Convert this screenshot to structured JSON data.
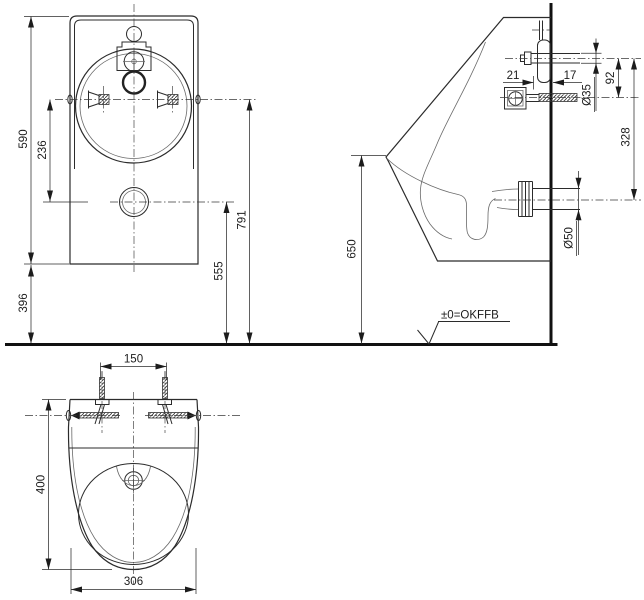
{
  "drawing": {
    "type": "technical-installation-drawing",
    "colors": {
      "line": "#2b2b2b",
      "background": "#ffffff"
    },
    "front_view": {
      "overall_height": "590",
      "fixing_to_drain": "236",
      "bottom_to_floor": "396",
      "fixing_height": "791",
      "drain_height": "555"
    },
    "side_view": {
      "fixing_offset_front": "21",
      "fixing_offset_back": "17",
      "inlet_diameter": "Ø35",
      "inlet_to_fixing": "92",
      "inlet_to_outlet": "328",
      "front_rim_height": "650",
      "outlet_diameter": "Ø50",
      "floor_level_label": "±0=OKFFB"
    },
    "plan_view": {
      "fixing_distance": "150",
      "depth": "400",
      "width": "306"
    }
  }
}
